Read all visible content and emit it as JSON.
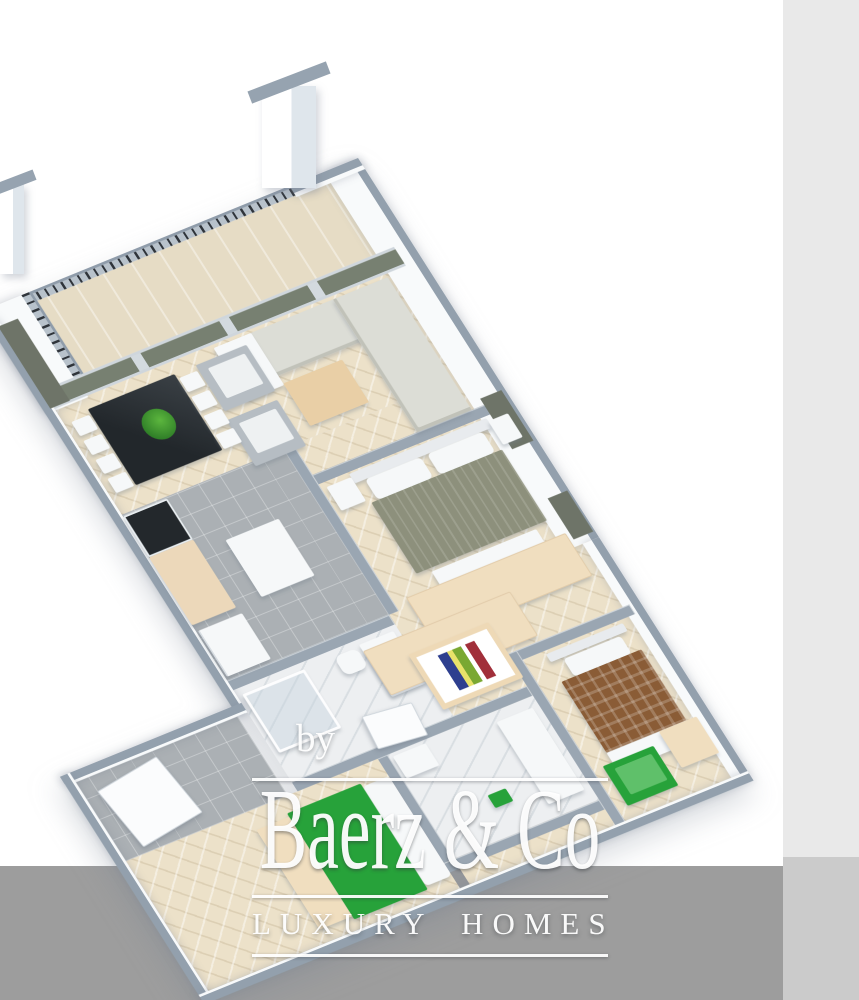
{
  "watermark": {
    "prefix": "by",
    "brand": "Baerz & Co",
    "tagline": "LUXURY HOMES"
  },
  "palette": {
    "background": "#ffffff",
    "side_panel": "#e9e9e9",
    "side_panel_lower": "#cbcbcb",
    "bottom_band": "#9d9d9d",
    "wall_cap": "#93a0ad",
    "wall_face": "#f8fafb",
    "wood_floor": "#ece1c9",
    "tile_floor": "#abb0b4",
    "marble_floor": "#edeff1",
    "balcony_floor": "#e6dcc5",
    "glass_panel": "#778071",
    "sofa": "#dcddd6",
    "armchair": "#b6bdc3",
    "coffee_table": "#e9cfa6",
    "dining_table": "#2b3033",
    "wardrobe_beige": "#f0debf",
    "bed1_cover": "#8d907c",
    "bed2_cover": "#8a5c36",
    "accent_green": "#27a23a",
    "watermark_white": "#ffffff"
  },
  "scene": {
    "kind": "3d-isometric-floor-plan",
    "rooms": [
      "balcony",
      "living-dining-room",
      "kitchen",
      "bedroom-1",
      "walk-in-closet",
      "bathroom-1",
      "bedroom-2",
      "hallway",
      "bathroom-2",
      "bedroom-3",
      "entry-hall"
    ]
  }
}
